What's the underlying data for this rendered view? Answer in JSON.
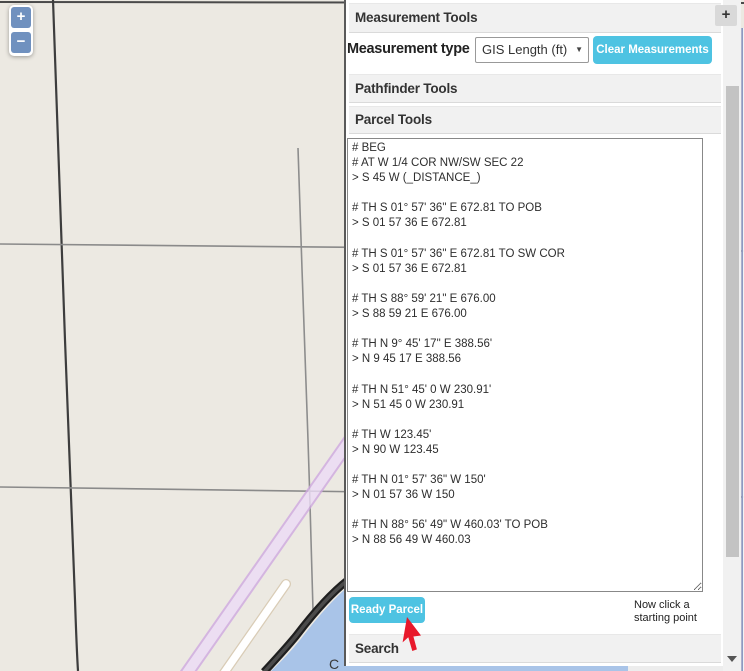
{
  "colors": {
    "accent": "#4ec3e2",
    "header_bg": "#f1f1f1",
    "zoom_blue": "#7091bf",
    "map_bg": "#ece9e2",
    "water": "#a9c4e8",
    "route_purple": "#e9d6f3",
    "cursor_red": "#e8192b"
  },
  "map": {
    "zoom_in": "+",
    "zoom_out": "−",
    "water_label": "C"
  },
  "panel": {
    "measurement_tools": {
      "title": "Measurement Tools",
      "expand_button": "+",
      "type_label": "Measurement type",
      "type_value": "GIS Length (ft)",
      "dropdown_arrow": "▼",
      "clear_button": "Clear Measurements"
    },
    "pathfinder_tools": {
      "title": "Pathfinder Tools"
    },
    "parcel_tools": {
      "title": "Parcel Tools",
      "traverse_lines": [
        "# BEG",
        "# AT W 1/4 COR NW/SW SEC 22",
        "> S 45 W (_DISTANCE_)",
        "",
        "# TH S 01° 57' 36\" E 672.81 TO POB",
        "> S 01 57 36 E 672.81",
        "",
        "# TH S 01° 57' 36\" E 672.81 TO SW COR",
        "> S 01 57 36 E 672.81",
        "",
        "# TH S 88° 59' 21\" E 676.00",
        "> S 88 59 21 E 676.00",
        "",
        "# TH N 9° 45' 17\" E 388.56'",
        "> N 9 45 17 E 388.56",
        "",
        "# TH N 51° 45' 0 W 230.91'",
        "> N 51 45 0 W 230.91",
        "",
        "# TH W 123.45'",
        "> N 90 W 123.45",
        "",
        "# TH N 01° 57' 36\" W 150'",
        "> N 01 57 36 W 150",
        "",
        "# TH N 88° 56' 49\" W 460.03' TO POB",
        "> N 88 56 49 W 460.03"
      ],
      "ready_button": "Ready Parcel",
      "hint_line1": "Now click a",
      "hint_line2": "starting point"
    },
    "search": {
      "title": "Search"
    }
  }
}
